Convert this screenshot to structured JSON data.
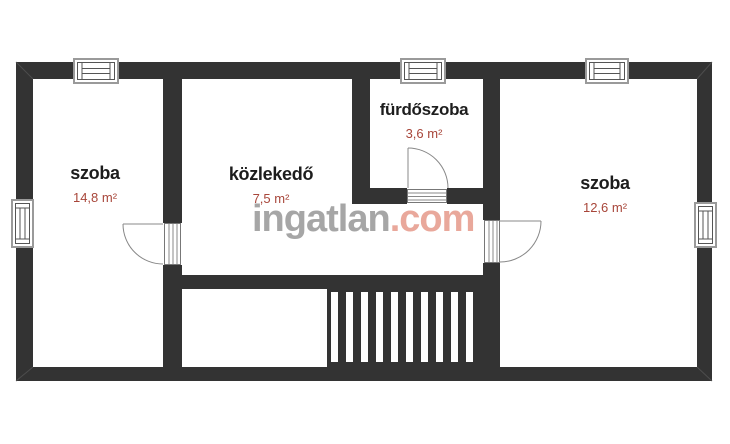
{
  "plan": {
    "type": "floor-plan",
    "rooms": [
      {
        "id": "szoba-left",
        "label": "szoba",
        "area": "14,8 m²"
      },
      {
        "id": "kozlekedo",
        "label": "közlekedő",
        "area": "7,5 m²"
      },
      {
        "id": "furdoszoba",
        "label": "fürdőszoba",
        "area": "3,6 m²"
      },
      {
        "id": "szoba-right",
        "label": "szoba",
        "area": "12,6 m²"
      }
    ],
    "features": [
      "stairs",
      "3 door swings",
      "5 windows"
    ]
  },
  "watermark": {
    "name": "ingatlan",
    "tld": ".com"
  },
  "colors": {
    "wall": "#333333",
    "room_label": "#1d1d1d",
    "area_value": "#a8463a",
    "watermark_name": "#a6a6a6",
    "watermark_tld": "#e9a89b",
    "window_frame": "#9a9a9a",
    "symbol_line": "#555555"
  }
}
